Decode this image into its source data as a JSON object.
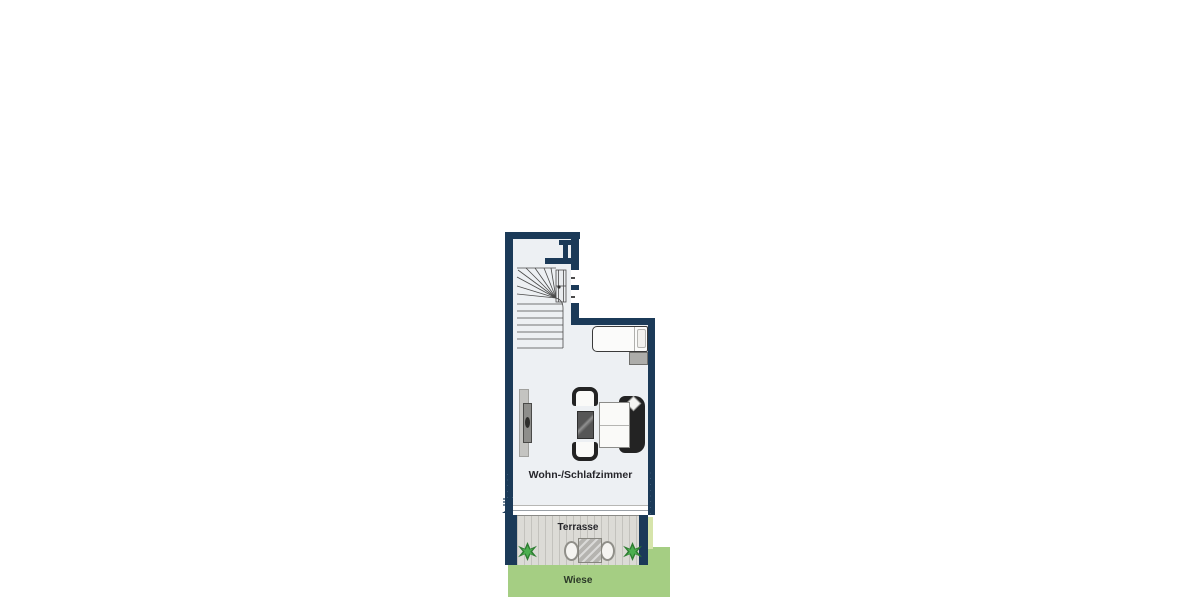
{
  "labels": {
    "living_room": "Wohn-/Schlafzimmer",
    "terrace": "Terrasse",
    "lawn": "Wiese"
  },
  "watermarks": {
    "left_wall": "· · · · · ·",
    "right_wall": "· · · · · · · ·"
  },
  "colors": {
    "wall": "#1b3a58",
    "floor": "#edf0f3",
    "deck": "#dcdbd6",
    "lawn": "#a5ce83",
    "lawn_light": "#d6e4ab",
    "furn_dark": "#232323"
  },
  "furniture_icons": [
    "winder-staircase",
    "entrance-door",
    "bed",
    "nightstand",
    "tv-sideboard",
    "armchair",
    "coffee-table",
    "sofa",
    "terrace-table",
    "terrace-chair",
    "shrub-plant"
  ]
}
